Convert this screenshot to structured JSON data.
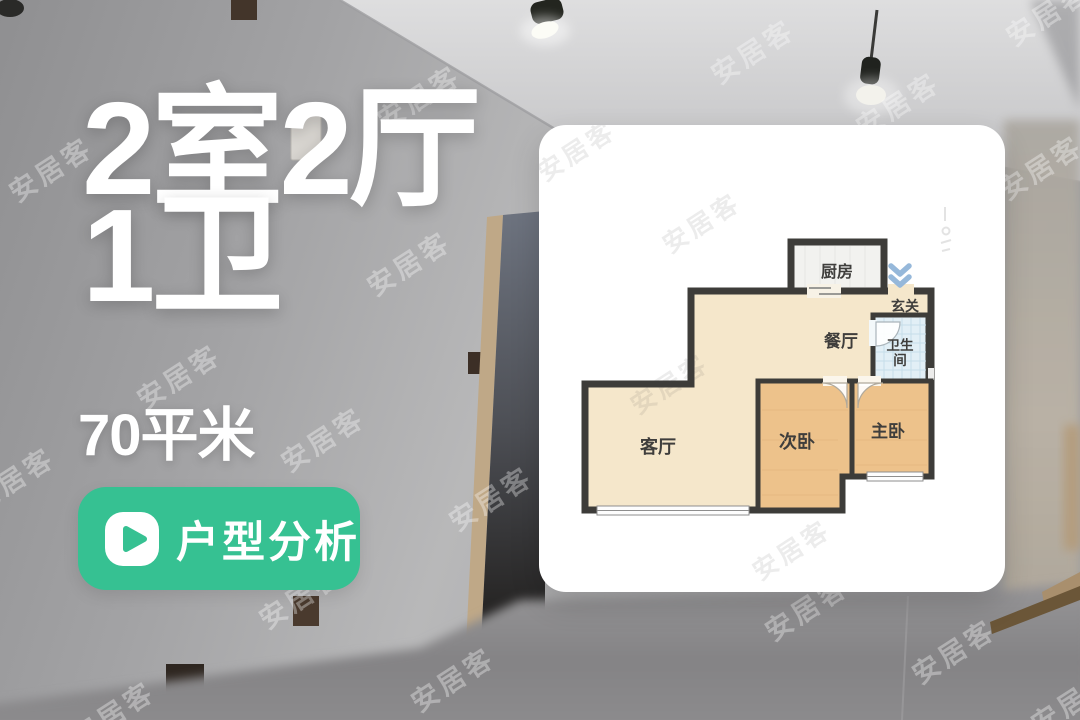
{
  "overlay": {
    "rooms_line1": "2室2厅",
    "rooms_line2": "1卫",
    "area_text": "70平米",
    "analysis_button_label": "户型分析"
  },
  "floorplan": {
    "rooms": [
      {
        "id": "kitchen",
        "label": "厨房"
      },
      {
        "id": "entry-hall",
        "label": "玄关"
      },
      {
        "id": "dining",
        "label": "餐厅"
      },
      {
        "id": "bathroom",
        "label": "卫生间"
      },
      {
        "id": "living",
        "label": "客厅"
      },
      {
        "id": "bedroom-second",
        "label": "次卧"
      },
      {
        "id": "bedroom-master",
        "label": "主卧"
      }
    ],
    "colors": {
      "wall": "#3d3c39",
      "hall_floor": "#f5e7cb",
      "bedroom_floor": "#edc28b",
      "bathroom_floor": "#e2eff6",
      "kitchen_floor": "#f2f2ef",
      "entry_arrow": "#96b8da"
    }
  },
  "button": {
    "color": "#36c192"
  },
  "watermark": {
    "text": "安居客"
  }
}
